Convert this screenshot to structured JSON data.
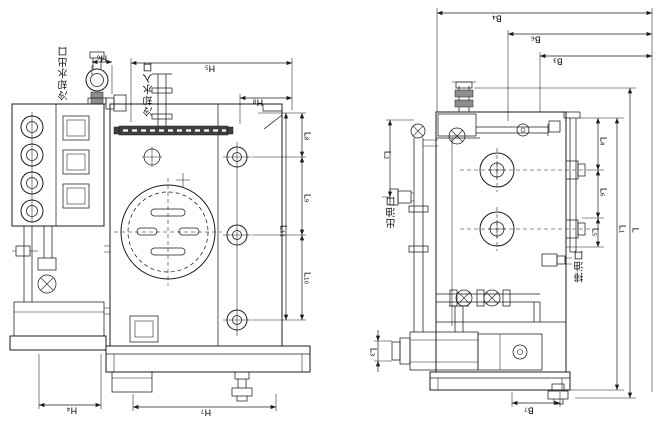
{
  "drawing": {
    "left_view": {
      "ports": {
        "cooling_water_outlet": "冷却水出口",
        "cooling_water_inlet": "冷却水入口"
      },
      "dims": {
        "h6": "H₆",
        "h5": "H₅",
        "h8": "H₈",
        "l8": "L₈",
        "l9": "L₉",
        "l11": "L₁₁",
        "l10": "L₁₀",
        "h4": "H₄",
        "h7": "H₇"
      }
    },
    "right_view": {
      "ports": {
        "oil_outlet": "出油口",
        "oil_drain": "排油口"
      },
      "dims": {
        "b4": "B₄",
        "b6": "B₆",
        "b3": "B₃",
        "l2": "L₂",
        "l4": "L₄",
        "l6": "L₆",
        "l5": "L₅",
        "l1": "L₁",
        "l": "L",
        "l3": "L₃",
        "b7": "B₇"
      }
    }
  }
}
